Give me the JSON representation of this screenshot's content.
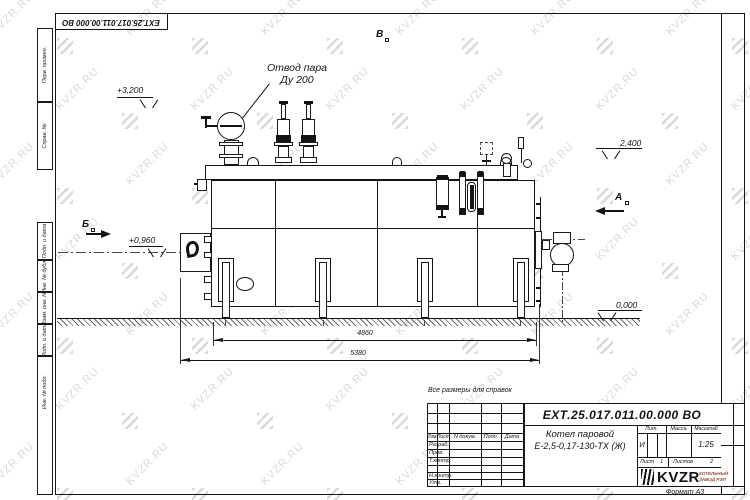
{
  "watermark": {
    "text": "KVZR.RU",
    "color": "#b9b9b9"
  },
  "frame": {
    "top_stamp": "ЕХТ.25.017.011.00.000 ВО",
    "margin_labels": [
      "Перв. примен.",
      "Справ. №",
      "Подп. и дата",
      "Инв. № дубл.",
      "Взам. инв. №",
      "Подп. и дата",
      "Инв. № подл."
    ]
  },
  "note": "Все размеры для справок",
  "drawing": {
    "callout": {
      "line1": "Отвод пара",
      "line2": "Ду 200"
    },
    "elevations": {
      "steam_outlet": "+3,200",
      "burner_axis": "+0,960",
      "boiler_top": "2,400",
      "ground": "0,000"
    },
    "dimensions": {
      "support_span": "4860",
      "overall_length": "5380"
    },
    "view_labels": {
      "left": "Б",
      "top": "В",
      "right": "А"
    }
  },
  "title_block": {
    "designation": "ЕХТ.25.017.011.00.000  ВО",
    "product_name_line1": "Котел паровой",
    "product_name_line2": "Е-2,5-0,17-130-ТХ (Ж)",
    "columns": {
      "izm": "Изм.",
      "list": "Лист",
      "doc": "N докум.",
      "podp": "Подп.",
      "data": "Дата"
    },
    "rows": {
      "razrab": "Разраб.",
      "prov": "Пров.",
      "tkontr": "Т.контр.",
      "nkontr": "Н.контр.",
      "utv": "Утв."
    },
    "props": {
      "lit_label": "Лит.",
      "mass_label": "Масса",
      "scale_label": "Масштаб",
      "lit": "И",
      "scale": "1:25",
      "sheet_label": "Лист",
      "sheet": "1",
      "sheets_label": "Листов",
      "sheets": "2"
    },
    "logo": {
      "name": "KVZR",
      "sub1": "КОТЕЛЬНЫЙ",
      "sub2": "ЗАВОД РЭП",
      "color": "#9c4532"
    },
    "format": "Формат А3"
  }
}
